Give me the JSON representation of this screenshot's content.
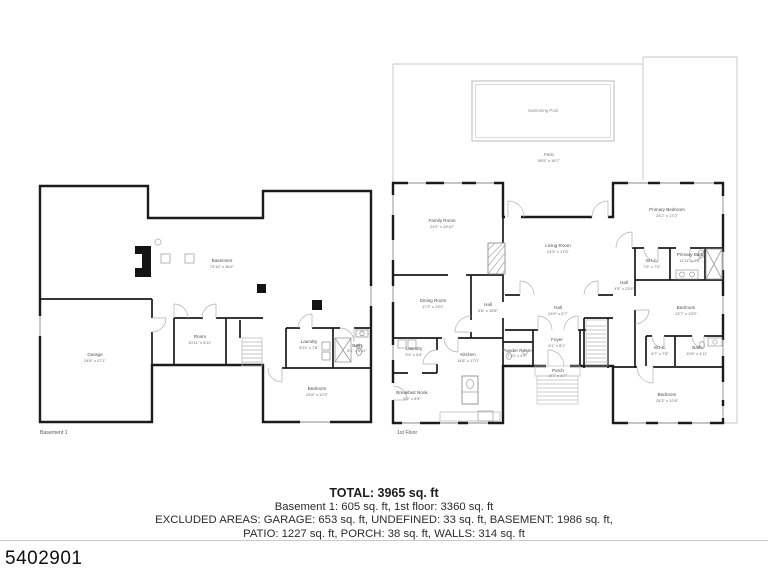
{
  "listing": {
    "number": "5402901"
  },
  "summary": {
    "total": "TOTAL: 3965 sq. ft",
    "floors": "Basement 1: 605 sq. ft, 1st floor: 3360 sq. ft",
    "excluded_1": "EXCLUDED AREAS: GARAGE: 653 sq. ft, UNDEFINED: 33 sq. ft, BASEMENT: 1986 sq. ft,",
    "excluded_2": "PATIO: 1227 sq. ft, PORCH: 38 sq. ft, WALLS: 314 sq. ft"
  },
  "plans": {
    "basement": {
      "caption": "Basement 1",
      "rooms": [
        {
          "name": "Basement",
          "dims": "73'10\" x 36'4\""
        },
        {
          "name": "Garage",
          "dims": "24'8\" x 27'1\""
        },
        {
          "name": "Room",
          "dims": "10'11\" x 8'11\""
        },
        {
          "name": "Laundry",
          "dims": "8'11\" x 7'8\""
        },
        {
          "name": "Bath",
          "dims": "8'1\" x 6'11\""
        },
        {
          "name": "Bedroom",
          "dims": "23'8\" x 12'3\""
        }
      ]
    },
    "first_floor": {
      "caption": "1st Floor",
      "rooms": [
        {
          "name": "Swimming Pool",
          "dims": ""
        },
        {
          "name": "Patio",
          "dims": "58'5\" x 16'7\""
        },
        {
          "name": "Family Room",
          "dims": "24'0\" x 19'10\""
        },
        {
          "name": "Living Room",
          "dims": "24'5\" x 17'6\""
        },
        {
          "name": "Dining Room",
          "dims": "17'3\" x 13'0\""
        },
        {
          "name": "Hall",
          "dims": "6'8\" x 15'8\""
        },
        {
          "name": "Laundry",
          "dims": "9'0\" x 8'6\""
        },
        {
          "name": "Kitchen",
          "dims": "14'8\" x 17'0\""
        },
        {
          "name": "Breakfast Nook",
          "dims": "9'0\" x 8'5\""
        },
        {
          "name": "Powder Room",
          "dims": "7'10\" x 4'9\""
        },
        {
          "name": "Hall",
          "dims": "24'6\" x 6'7\""
        },
        {
          "name": "Foyer",
          "dims": "9'1\" x 8'1\""
        },
        {
          "name": "Porch",
          "dims": "8'7\" x 4'7\""
        },
        {
          "name": "Primary Bedroom",
          "dims": "24'2\" x 17'2\""
        },
        {
          "name": "W.I.C.",
          "dims": "7'6\" x 7'0\""
        },
        {
          "name": "Primary Bath",
          "dims": "11'11\" x 7'0\""
        },
        {
          "name": "Hall",
          "dims": "4'5\" x 23'9\""
        },
        {
          "name": "Bedroom",
          "dims": "13'7\" x 13'0\""
        },
        {
          "name": "W.I.C.",
          "dims": "6'7\" x 7'8\""
        },
        {
          "name": "Bath",
          "dims": "10'8\" x 4'11\""
        },
        {
          "name": "Bedroom",
          "dims": "24'3\" x 12'8\""
        }
      ]
    }
  }
}
